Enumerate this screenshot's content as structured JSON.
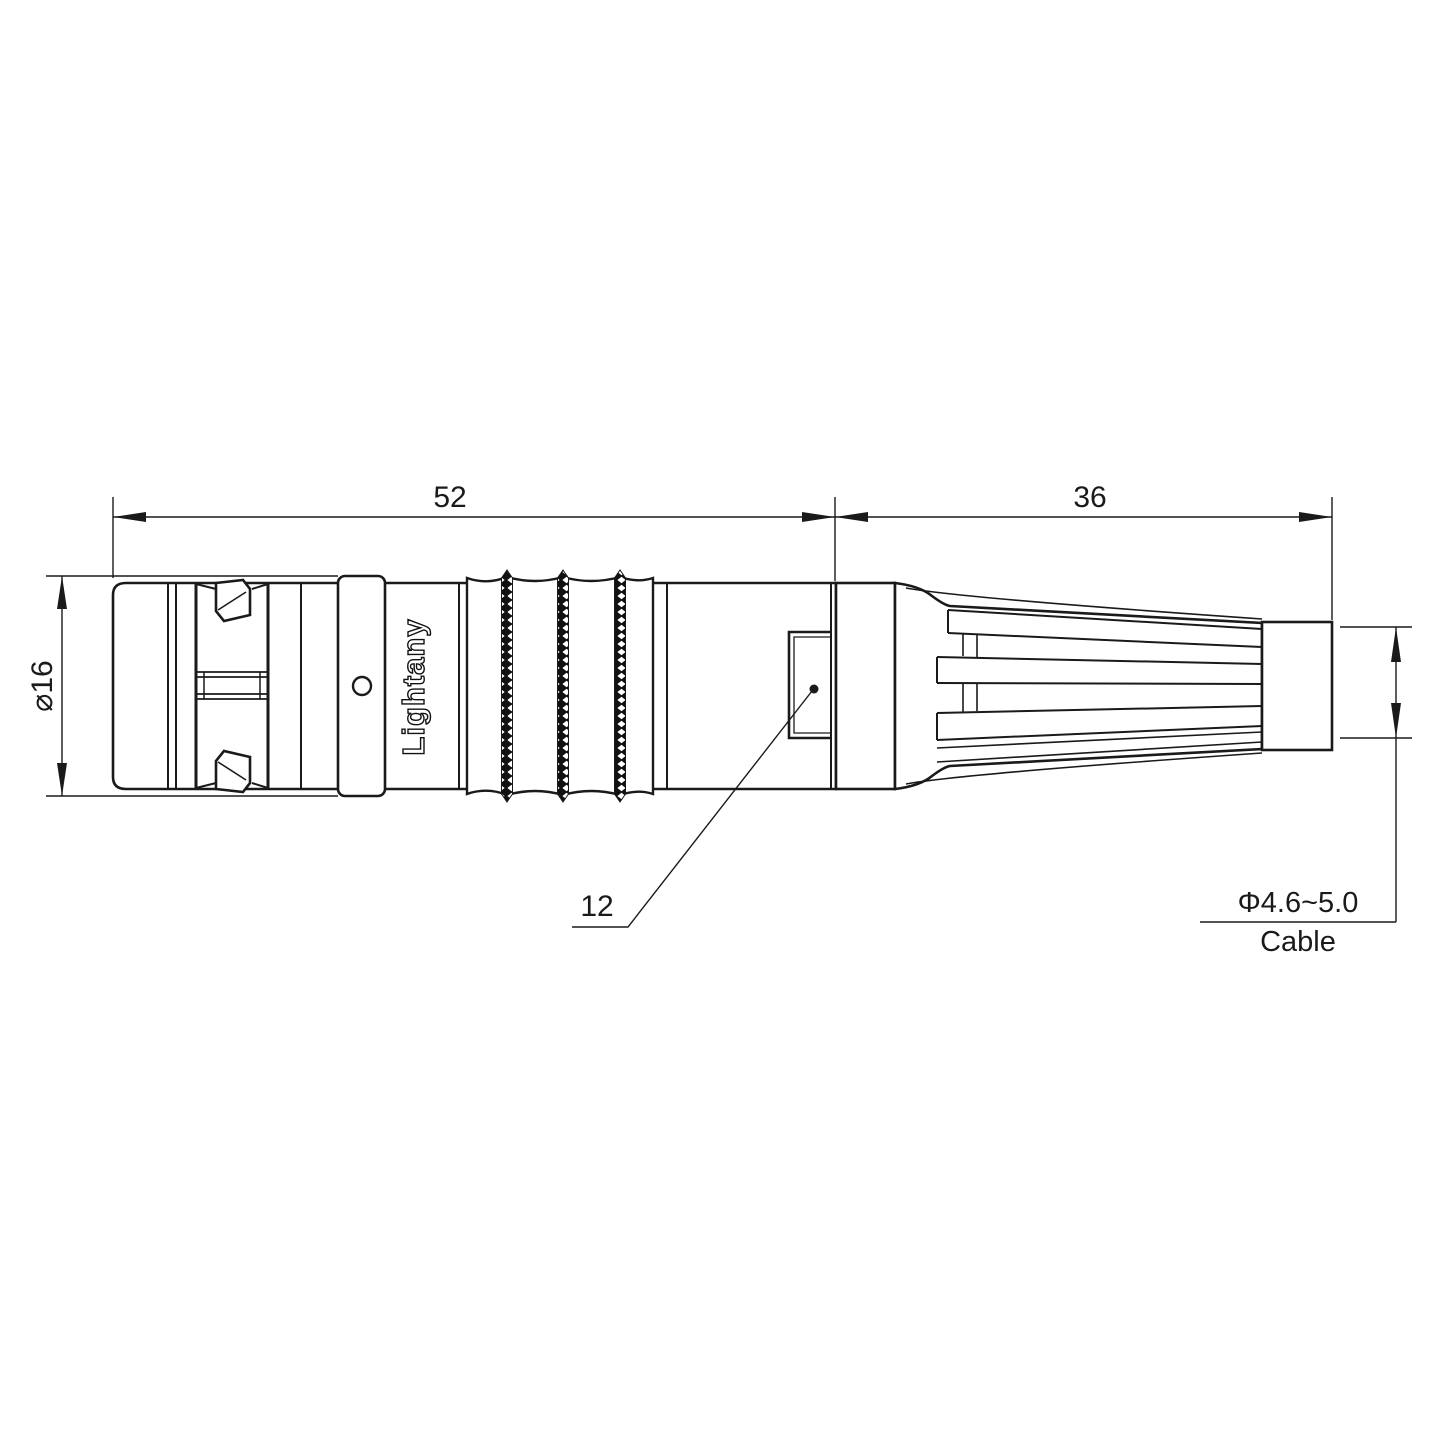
{
  "meta": {
    "background": "#ffffff",
    "line_color": "#1a1a1a",
    "watermark_color": "#f2a6a6"
  },
  "dimensions": {
    "front_length": "52",
    "rear_length": "36",
    "diameter": "⌀16",
    "detail": "12",
    "cable_diameter": "Φ4.6~5.0",
    "cable_label": "Cable"
  },
  "branding": {
    "body_text": "Lightany",
    "watermark": "Lightany"
  }
}
